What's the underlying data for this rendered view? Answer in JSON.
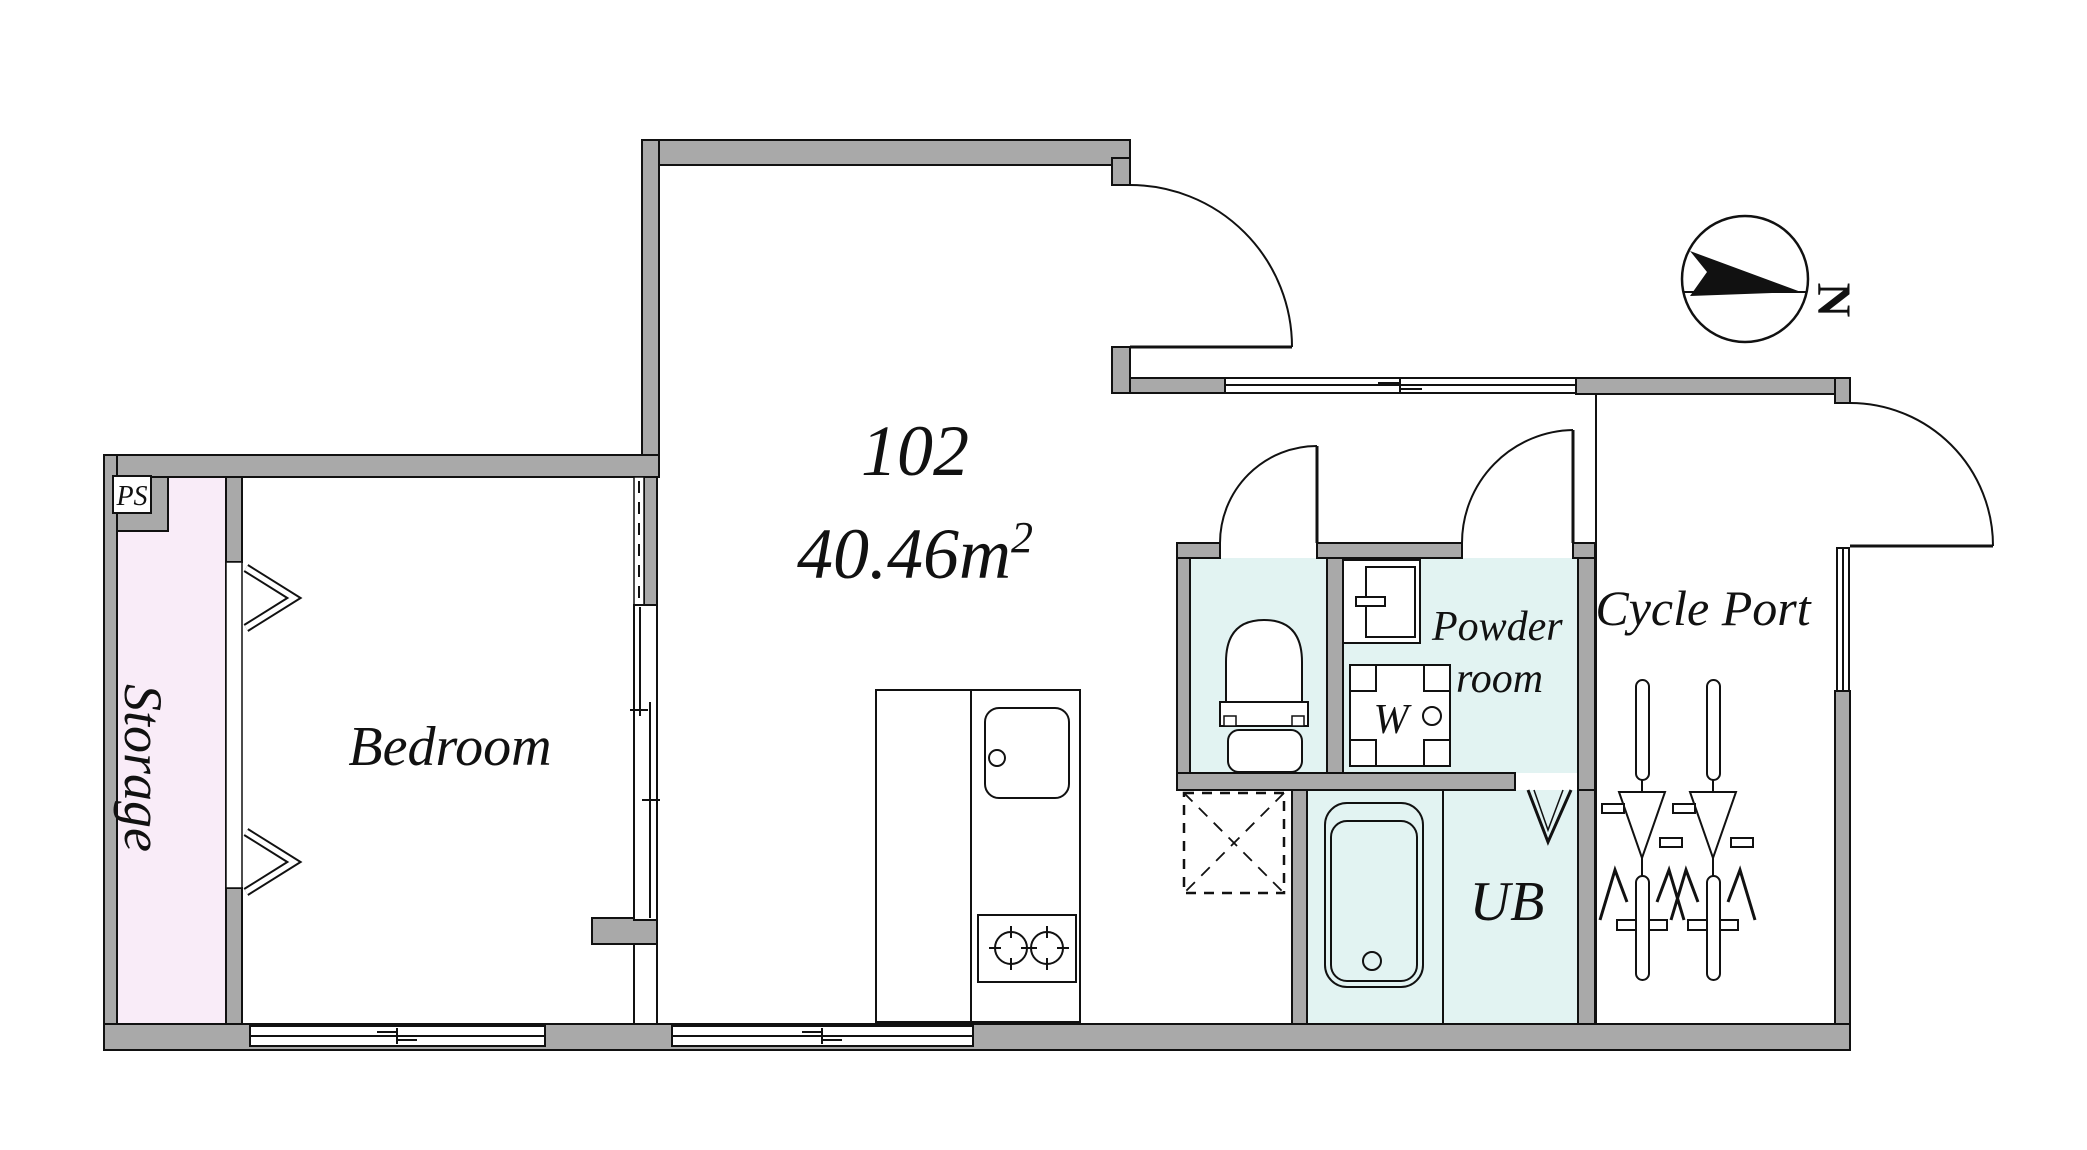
{
  "unit": {
    "number": "102",
    "area": "40.46m",
    "area_sup": "2"
  },
  "rooms": {
    "bedroom": "Bedroom",
    "storage": "Storage",
    "pipe_space": "PS",
    "powder_line1": "Powder",
    "powder_line2": "room",
    "washer": "W",
    "unit_bath": "UB",
    "cycle_port": "Cycle Port"
  },
  "compass": {
    "north": "N"
  },
  "colors": {
    "wall_color": "#a9a9a9",
    "storage_color": "#f9ecf8",
    "wet_color": "#e2f3f2",
    "line_color": "#111111"
  }
}
